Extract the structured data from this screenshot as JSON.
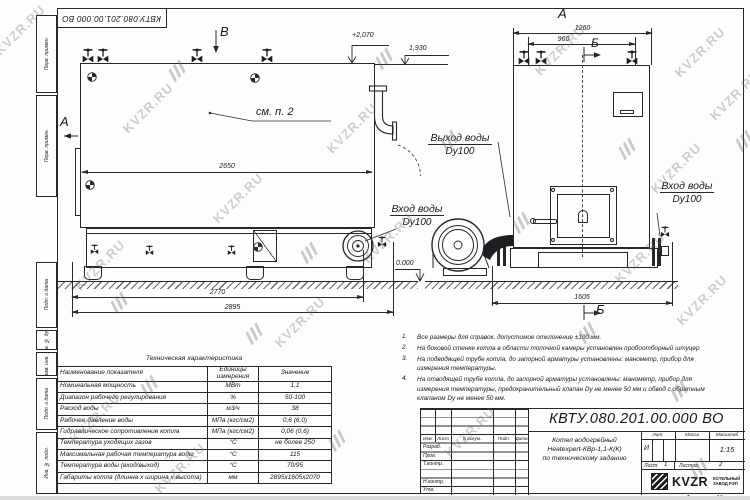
{
  "watermark": {
    "text": "KVZR.RU",
    "text_spots": [
      [
        20,
        30
      ],
      [
        100,
        265
      ],
      [
        148,
        108
      ],
      [
        238,
        198
      ],
      [
        352,
        128
      ],
      [
        300,
        322
      ],
      [
        388,
        238
      ],
      [
        560,
        50
      ],
      [
        700,
        52
      ],
      [
        676,
        168
      ],
      [
        640,
        258
      ],
      [
        702,
        300
      ],
      [
        470,
        432
      ],
      [
        180,
        468
      ],
      [
        95,
        418
      ],
      [
        735,
        95
      ]
    ],
    "logo_spots": [
      [
        178,
        70
      ],
      [
        385,
        58
      ],
      [
        450,
        140
      ],
      [
        310,
        252
      ],
      [
        120,
        302
      ],
      [
        628,
        148
      ],
      [
        522,
        222
      ],
      [
        588,
        332
      ],
      [
        255,
        333
      ],
      [
        150,
        385
      ],
      [
        680,
        390
      ],
      [
        338,
        440
      ],
      [
        700,
        468
      ],
      [
        745,
        140
      ]
    ]
  },
  "stamp": {
    "code": "КВТУ.080.201.00.000  ВО"
  },
  "side_strip": {
    "labels": [
      "Перв. примен.",
      "Перв. примен.",
      "Подп. и дата",
      "Инв. № дубл.",
      "Взам. инв. №",
      "Подп. и дата",
      "Инв. № подл."
    ]
  },
  "views": {
    "label_a_left": "А",
    "label_b_top": "В",
    "label_a_top": "А",
    "label_b_front_top": "Б",
    "label_b_front_bottom": "Б",
    "see_note": "см. п. 2",
    "outlet_label": "Выход воды",
    "outlet_dn": "Dy100",
    "inlet_bottom_label": "Вход воды",
    "inlet_bottom_dn": "Dy100",
    "inlet_right_label": "Вход воды",
    "inlet_right_dn": "Dy100",
    "elev_top": "+2,070",
    "elev_ledge": "1,930",
    "elev_zero": "0.000",
    "dim_2650": "2650",
    "dim_2770": "2770",
    "dim_2895": "2895",
    "dim_1260": "1260",
    "dim_960": "960",
    "dim_1605": "1605"
  },
  "notes": {
    "items": [
      {
        "num": "1.",
        "text": "Все размеры для справок, допустимое отклонение  ±100 мм."
      },
      {
        "num": "2.",
        "text": "На боковой стенке котла в области топочной камеры установлен пробоотборный штуцер"
      },
      {
        "num": "3.",
        "text": "На  подводящей трубе котла, до запорной арматуры установлены: манометр, прибор для измерения температуры."
      },
      {
        "num": "4.",
        "text": "На отводящей трубе котла, до запорной арматуры установлены: манометр, прибор для измерения температуры, предохранительный клапан Dу не менее 50 мм и обвод с обратным клапаном Dу не менее 50 мм."
      }
    ]
  },
  "tech_table": {
    "title": "Техническая характеристика",
    "col_name": "Наименование показателя",
    "col_units": "Единицы измерения",
    "col_value": "Значение",
    "rows": [
      {
        "name": "Номинальная мощность",
        "units": "МВт",
        "value": "1,1"
      },
      {
        "name": "Диапазон рабочего регулирования",
        "units": "%",
        "value": "50-100"
      },
      {
        "name": "Расход воды",
        "units": "м3/ч",
        "value": "38"
      },
      {
        "name": "Рабочее давление воды",
        "units": "МПа (кгс/см2)",
        "value": "0,6 (6,0)"
      },
      {
        "name": "Гидравлическое сопротивление котла",
        "units": "МПа (кгс/см2)",
        "value": "0,06 (0,6)"
      },
      {
        "name": "Температура уходящих газов",
        "units": "°С",
        "value": "не более 250"
      },
      {
        "name": "Максимальная рабочая температура воды",
        "units": "°С",
        "value": "115"
      },
      {
        "name": "Температура воды (вход/выход)",
        "units": "°С",
        "value": "70/95"
      },
      {
        "name": "Габариты котла (длинна х ширина х высота)",
        "units": "мм",
        "value": "2895х1605х2070"
      }
    ]
  },
  "title_block": {
    "designation": "КВТУ.080.201.00.000  ВО",
    "name_lines": [
      "Котел водогрейный",
      "Heatexpert-КВр-1,1-К(К)",
      "по техническому заданию"
    ],
    "rev_headers": [
      "Изм.",
      "Лист",
      "N докум.",
      "Подп.",
      "Дата"
    ],
    "sign_rows": [
      "Разраб.",
      "Пров.",
      "Т.контр.",
      "",
      "Н.контр.",
      "Утв."
    ],
    "lit_label": "Лит.",
    "lit_value": "И",
    "mass_label": "Масса",
    "scale_label": "Масштаб",
    "scale_value": "1:15",
    "sheet_label": "Лист",
    "sheet_value": "1",
    "sheets_label": "Листов",
    "sheets_value": "2",
    "logo_text": "KVZR",
    "company_lines": [
      "КОТЕЛЬНЫЙ",
      "ЗАВОД РЭП"
    ],
    "format_label": "Формат",
    "format_value": "А3"
  }
}
